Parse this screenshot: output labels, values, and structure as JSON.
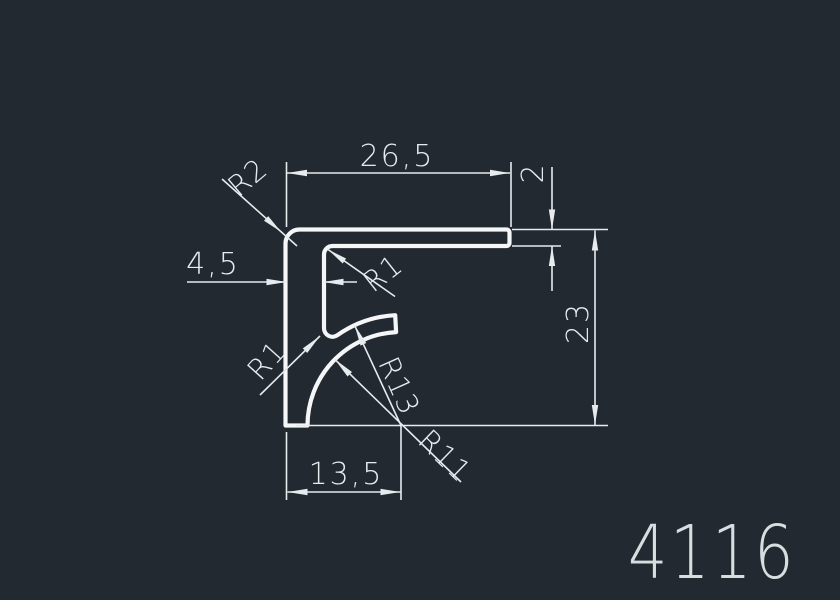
{
  "drawing": {
    "number": "4116",
    "dims": {
      "top_width": "26,5",
      "arm_thickness": "2",
      "leg_width": "4,5",
      "total_height": "23",
      "bottom_width": "13,5"
    },
    "radii": {
      "outer_corner": "R2",
      "inner_corner": "R1",
      "fin_root": "R1",
      "fin_outer": "R13",
      "fin_inner": "R11"
    },
    "colors": {
      "background": "#232931",
      "profile_line": "#f4f6f7",
      "dimension_line": "#e7ebee",
      "number_text": "#d8dde0"
    }
  }
}
